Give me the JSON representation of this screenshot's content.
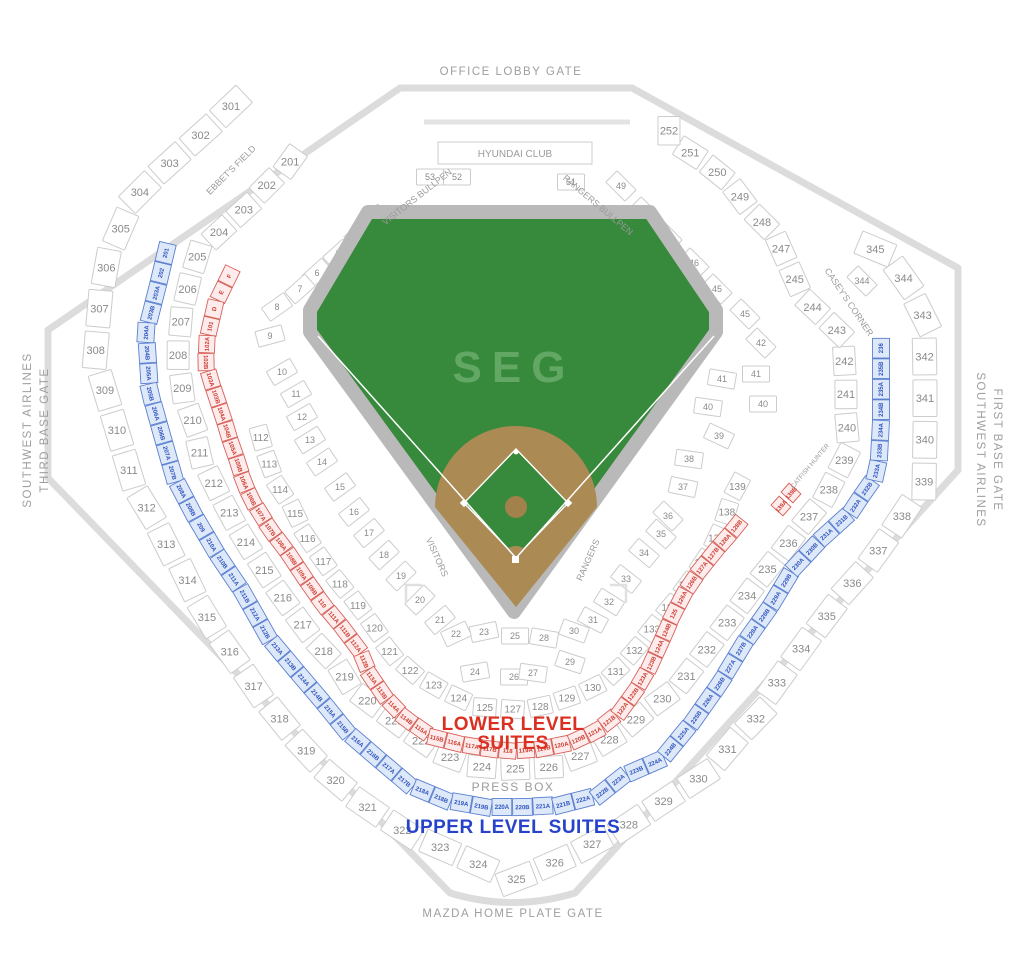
{
  "labels": {
    "office_lobby_gate": "OFFICE LOBBY GATE",
    "mazda_gate": "MAZDA HOME PLATE GATE",
    "third_base_gate_line1": "SOUTHWEST AIRLINES",
    "third_base_gate_line2": "THIRD BASE GATE",
    "first_base_gate_line1": "SOUTHWEST AIRLINES",
    "first_base_gate_line2": "FIRST BASE GATE",
    "press_box": "PRESS BOX",
    "lower_suites_line1": "LOWER LEVEL",
    "lower_suites_line2": "SUITES",
    "upper_suites": "UPPER LEVEL SUITES",
    "hyundai_club": "HYUNDAI CLUB",
    "visitors_bullpen": "VISITORS BULLPEN",
    "rangers_bullpen": "RANGERS BULLPEN",
    "ebbets_field": "EBBET'S FIELD",
    "caseys_corner": "CASEY'S CORNER",
    "catfish_hunter": "CATFISH HUNTER",
    "visitors_dugout": "VISITORS",
    "rangers_dugout": "RANGERS",
    "field_logo": "SEG"
  },
  "colors": {
    "field_green": "#37893b",
    "logo_green": "#63a765",
    "infield_dirt": "#ab8a54",
    "track_gray": "#b9b9b9",
    "suite_red": "#cd3c31",
    "suite_blue": "#3054c0",
    "legend_red": "#da2f21",
    "legend_blue": "#2743cb",
    "section_text": "#8a8a8a",
    "wall_gray": "#dcdcdc"
  },
  "rings": {
    "upper_300": [
      "301",
      "302",
      "303",
      "304",
      "305",
      "306",
      "307",
      "308",
      "309",
      "310",
      "311",
      "312",
      "313",
      "314",
      "315",
      "316",
      "317",
      "318",
      "319",
      "320",
      "321",
      "322",
      "323",
      "324",
      "325",
      "326",
      "327",
      "328",
      "329",
      "330",
      "331",
      "332",
      "333",
      "334",
      "335",
      "336",
      "337",
      "338",
      "339",
      "340",
      "341",
      "342",
      "343",
      "344",
      "345"
    ],
    "mezz_200": [
      "201",
      "202",
      "203",
      "204",
      "205",
      "206",
      "207",
      "208",
      "209",
      "210",
      "211",
      "212",
      "213",
      "214",
      "215",
      "216",
      "217",
      "218",
      "219",
      "220",
      "221",
      "222",
      "223",
      "224",
      "225",
      "226",
      "227",
      "228",
      "229",
      "230",
      "231",
      "232",
      "233",
      "234",
      "235",
      "236",
      "237",
      "238",
      "239",
      "240",
      "241",
      "242",
      "243",
      "244",
      "245",
      "247",
      "248",
      "249",
      "250",
      "251",
      "252"
    ],
    "terrace_100": [
      "112",
      "113",
      "114",
      "115",
      "116",
      "117",
      "118",
      "119",
      "120",
      "121",
      "122",
      "123",
      "124",
      "125",
      "127",
      "128",
      "129",
      "130",
      "131",
      "132",
      "133",
      "134",
      "135",
      "136",
      "137",
      "138",
      "139"
    ]
  },
  "suites": {
    "upper_blue": [
      "201",
      "202",
      "203A",
      "203B",
      "204A",
      "204B",
      "205A",
      "205B",
      "206A",
      "206B",
      "207A",
      "207B",
      "208A",
      "208B",
      "209",
      "210A",
      "210B",
      "211A",
      "211B",
      "212A",
      "212B",
      "213A",
      "213B",
      "214A",
      "214B",
      "215A",
      "215B",
      "216A",
      "216B",
      "217A",
      "217B",
      "218A",
      "218B",
      "219A",
      "219B",
      "220A",
      "220B",
      "221A",
      "221B",
      "222A",
      "222B",
      "223A",
      "223B",
      "224A",
      "224B",
      "225A",
      "225B",
      "226A",
      "226B",
      "227A",
      "227B",
      "228A",
      "228B",
      "229A",
      "229B",
      "230A",
      "230B",
      "231A",
      "231B",
      "232A",
      "232B",
      "233A",
      "233B",
      "234A",
      "234B",
      "235A",
      "235B",
      "236"
    ],
    "lower_red": [
      "F",
      "E",
      "D",
      "101",
      "102A",
      "102B",
      "103A",
      "103B",
      "104A",
      "104B",
      "105A",
      "105B",
      "106A",
      "106B",
      "107A",
      "107B",
      "108A",
      "108B",
      "109A",
      "109B",
      "110",
      "111A",
      "111B",
      "112A",
      "112B",
      "113A",
      "113B",
      "114A",
      "114B",
      "115A",
      "115B",
      "116A",
      "117A",
      "117B",
      "118",
      "119A",
      "119B",
      "120A",
      "120B",
      "121A",
      "121B",
      "122A",
      "122B",
      "123A",
      "123B",
      "124A",
      "124B",
      "125",
      "126A",
      "126B",
      "127A",
      "127B",
      "128A",
      "128B"
    ],
    "lower_red_right": [
      {
        "label": "139A",
        "x": 781,
        "y": 506,
        "r": -48
      },
      {
        "label": "139B",
        "x": 791,
        "y": 493,
        "r": -48
      }
    ]
  },
  "field_boxes": [
    {
      "label": "3",
      "x": 373,
      "y": 219,
      "r": -42
    },
    {
      "label": "4",
      "x": 359,
      "y": 234,
      "r": -42
    },
    {
      "label": "5",
      "x": 338,
      "y": 254,
      "r": -42
    },
    {
      "label": "6",
      "x": 317,
      "y": 273,
      "r": -42
    },
    {
      "label": "7",
      "x": 300,
      "y": 289,
      "r": -42
    },
    {
      "label": "8",
      "x": 277,
      "y": 307,
      "r": -35
    },
    {
      "label": "9",
      "x": 270,
      "y": 336,
      "r": -15
    },
    {
      "label": "10",
      "x": 282,
      "y": 372,
      "r": -30
    },
    {
      "label": "11",
      "x": 296,
      "y": 394,
      "r": -30
    },
    {
      "label": "12",
      "x": 302,
      "y": 417,
      "r": -30
    },
    {
      "label": "13",
      "x": 310,
      "y": 440,
      "r": -32
    },
    {
      "label": "14",
      "x": 322,
      "y": 462,
      "r": -34
    },
    {
      "label": "15",
      "x": 340,
      "y": 487,
      "r": -36
    },
    {
      "label": "16",
      "x": 354,
      "y": 512,
      "r": -38
    },
    {
      "label": "17",
      "x": 369,
      "y": 533,
      "r": -40
    },
    {
      "label": "18",
      "x": 384,
      "y": 555,
      "r": -42
    },
    {
      "label": "19",
      "x": 401,
      "y": 576,
      "r": -44
    },
    {
      "label": "20",
      "x": 420,
      "y": 600,
      "r": -45
    },
    {
      "label": "21",
      "x": 440,
      "y": 620,
      "r": -40
    },
    {
      "label": "22",
      "x": 456,
      "y": 634,
      "r": -25
    },
    {
      "label": "23",
      "x": 484,
      "y": 632,
      "r": -12
    },
    {
      "label": "24",
      "x": 475,
      "y": 672,
      "r": -10
    },
    {
      "label": "25",
      "x": 515,
      "y": 636,
      "r": 0
    },
    {
      "label": "26",
      "x": 514,
      "y": 677,
      "r": 0
    },
    {
      "label": "27",
      "x": 533,
      "y": 673,
      "r": 8
    },
    {
      "label": "28",
      "x": 544,
      "y": 638,
      "r": 10
    },
    {
      "label": "29",
      "x": 570,
      "y": 662,
      "r": 18
    },
    {
      "label": "30",
      "x": 574,
      "y": 631,
      "r": 20
    },
    {
      "label": "31",
      "x": 593,
      "y": 620,
      "r": 28
    },
    {
      "label": "32",
      "x": 609,
      "y": 602,
      "r": 32
    },
    {
      "label": "33",
      "x": 626,
      "y": 579,
      "r": 38
    },
    {
      "label": "34",
      "x": 644,
      "y": 553,
      "r": 40
    },
    {
      "label": "35",
      "x": 661,
      "y": 534,
      "r": 42
    },
    {
      "label": "36",
      "x": 668,
      "y": 516,
      "r": 44
    },
    {
      "label": "37",
      "x": 683,
      "y": 487,
      "r": 12
    },
    {
      "label": "38",
      "x": 689,
      "y": 459,
      "r": 8
    },
    {
      "label": "39",
      "x": 719,
      "y": 436,
      "r": 25
    },
    {
      "label": "40",
      "x": 708,
      "y": 407,
      "r": 8
    },
    {
      "label": "41",
      "x": 722,
      "y": 379,
      "r": 10
    },
    {
      "label": "40",
      "x": 763,
      "y": 404,
      "r": 0
    },
    {
      "label": "41",
      "x": 756,
      "y": 374,
      "r": 0
    },
    {
      "label": "42",
      "x": 761,
      "y": 343,
      "r": 45
    },
    {
      "label": "45",
      "x": 745,
      "y": 314,
      "r": 45
    },
    {
      "label": "45",
      "x": 717,
      "y": 289,
      "r": 45
    },
    {
      "label": "46",
      "x": 694,
      "y": 263,
      "r": 45
    },
    {
      "label": "47",
      "x": 667,
      "y": 236,
      "r": 45
    },
    {
      "label": "48",
      "x": 645,
      "y": 212,
      "r": 45
    },
    {
      "label": "49",
      "x": 621,
      "y": 186,
      "r": 45
    },
    {
      "label": "51",
      "x": 571,
      "y": 182,
      "r": 0
    },
    {
      "label": "52",
      "x": 457,
      "y": 177,
      "r": 0
    },
    {
      "label": "53",
      "x": 430,
      "y": 177,
      "r": 0
    },
    {
      "label": "344",
      "x": 862,
      "y": 281,
      "r": 45
    }
  ]
}
